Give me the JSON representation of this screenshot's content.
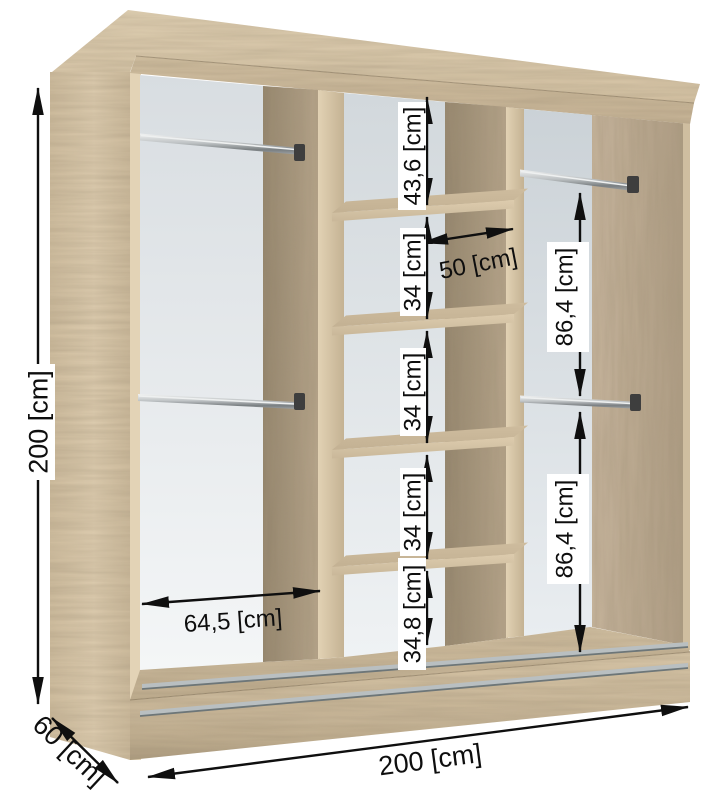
{
  "diagram": {
    "subject": "wardrobe-interior-dimension-diagram",
    "unit": "cm",
    "labels": {
      "height_total": "200 [cm]",
      "width_total": "200 [cm]",
      "depth_total": "60 [cm]",
      "left_inner_width": "64,5 [cm]",
      "middle_shelf_width": "50 [cm]",
      "middle_gaps": [
        "43,6 [cm]",
        "34 [cm]",
        "34 [cm]",
        "34 [cm]",
        "34,8 [cm]"
      ],
      "right_upper_gap": "86,4 [cm]",
      "right_lower_gap": "86,4 [cm]"
    },
    "values_cm": {
      "height": 200,
      "width": 200,
      "depth": 60,
      "left_inner_width": 64.5,
      "middle_shelf_width": 50,
      "middle_gaps": [
        43.6,
        34,
        34,
        34,
        34.8
      ],
      "right_gaps": [
        86.4,
        86.4
      ]
    },
    "colors": {
      "wood_light": "#d9c8ab",
      "wood_mid": "#c6b295",
      "wood_deep": "#a5957b",
      "back_panel_light": "#f3f5f6",
      "back_panel_shade": "#d6dce0",
      "metal": "#8f9598",
      "dimension_ink": "#0e0e0e",
      "background": "#ffffff"
    }
  }
}
